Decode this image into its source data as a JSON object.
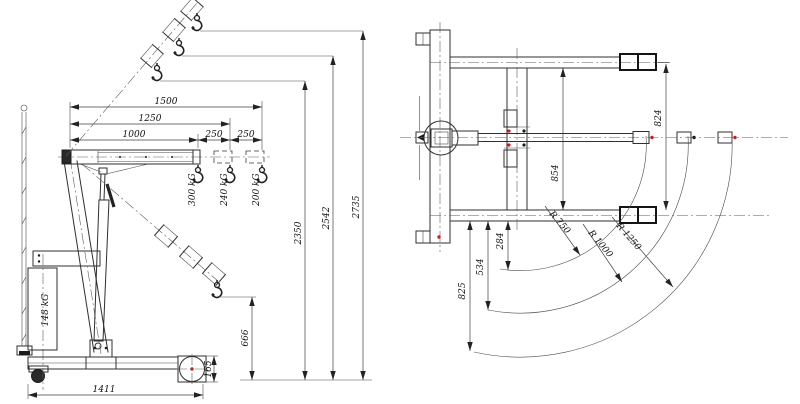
{
  "drawing": {
    "colors": {
      "line": "#2f2f2f",
      "text": "#101010",
      "accent_red": "#c42222",
      "background": "#ffffff"
    },
    "side_view": {
      "counterweight_label": "148 kG",
      "capacity_labels": {
        "ext_1000": "300 kG",
        "ext_1250": "240 kG",
        "ext_1500": "200 kG"
      },
      "dims": {
        "boom_1000": "1000",
        "boom_1250": "1250",
        "boom_1500": "1500",
        "step_a": "250",
        "step_b": "250",
        "height_min": "2350",
        "height_mid": "2542",
        "height_max": "2735",
        "hook_low": "666",
        "wheel_box": "165",
        "base_length": "1411"
      }
    },
    "top_view": {
      "dims": {
        "span_inner": "854",
        "span_outer": "824",
        "arc_offset_1": "284",
        "arc_offset_2": "534",
        "arc_offset_3": "825"
      },
      "radii": {
        "r750": "R 750",
        "r1000": "R 1000",
        "r1250": "R 1250"
      }
    }
  }
}
